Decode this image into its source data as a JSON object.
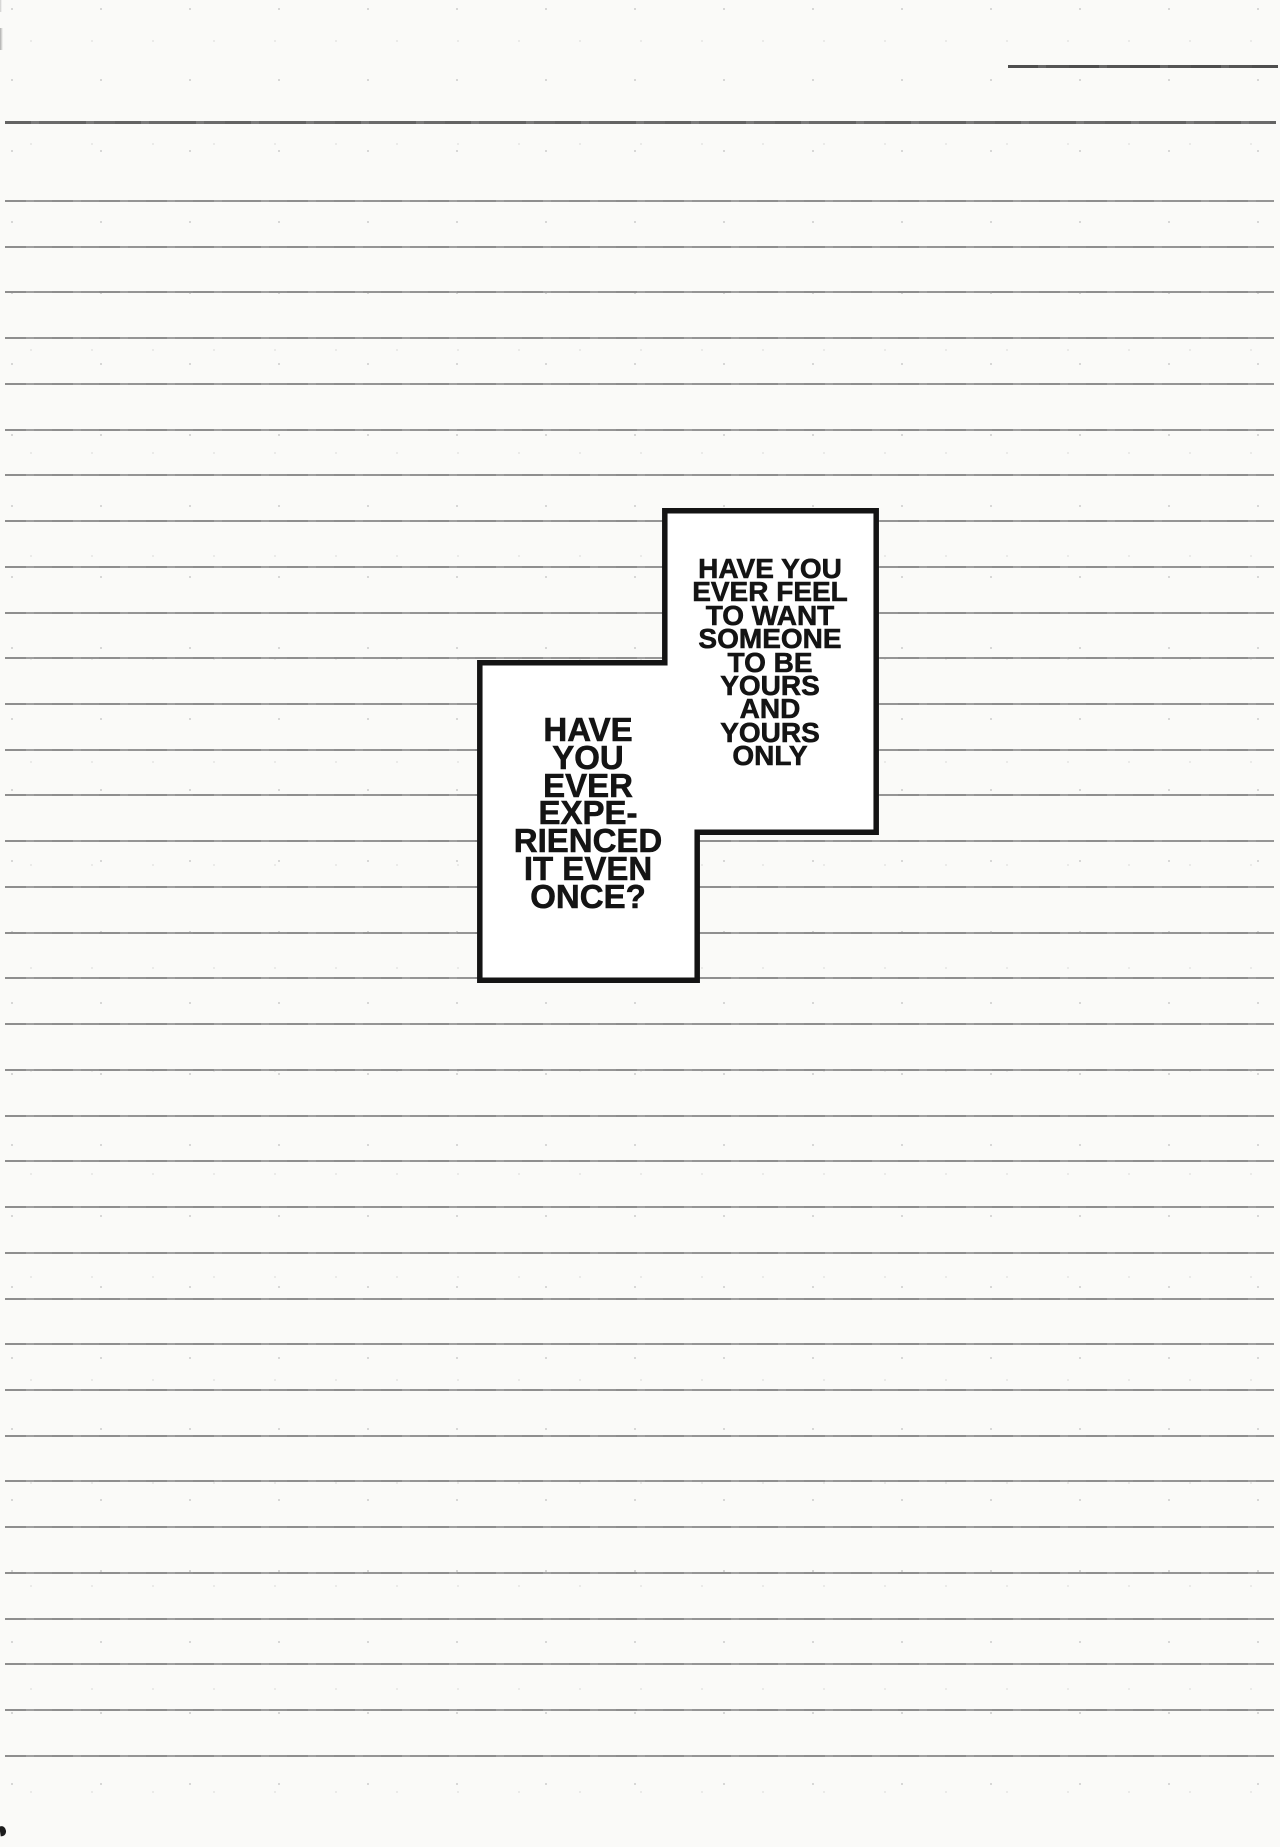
{
  "bubbles": {
    "right": {
      "lines": [
        "HAVE YOU",
        "EVER FEEL",
        "TO WANT",
        "SOMEONE",
        "TO BE",
        "YOURS",
        "AND",
        "YOURS",
        "ONLY"
      ],
      "text": "HAVE YOU\nEVER FEEL\nTO WANT\nSOMEONE\nTO BE\nYOURS\nAND\nYOURS\nONLY"
    },
    "left": {
      "lines": [
        "HAVE",
        "YOU",
        "EVER",
        "EXPE-",
        "RIENCED",
        "IT EVEN",
        "ONCE?"
      ],
      "text": "HAVE\nYOU\nEVER\nEXPE-\nRIENCED\nIT EVEN\nONCE?"
    }
  },
  "colors": {
    "paper": "#fafaf8",
    "rule_line": "#939393",
    "margin_line": "#696969",
    "top_right_line": "#525252",
    "ink": "#141414",
    "bubble_fill": "#ffffff"
  },
  "decor": {
    "rules": {
      "start_y": 200,
      "spacing": 45.73,
      "count": 35
    },
    "margin_rule_y": 121,
    "top_right_line": {
      "x": 1008,
      "y": 65,
      "width": 270
    },
    "bubble_points": "664.8,510.8 876.2,510.8 876.2,832.2 697.2,832.2 697.2,980.2 479.8,980.2 479.8,662.8 664.8,662.8",
    "bubble_stroke_width": 5.5
  }
}
